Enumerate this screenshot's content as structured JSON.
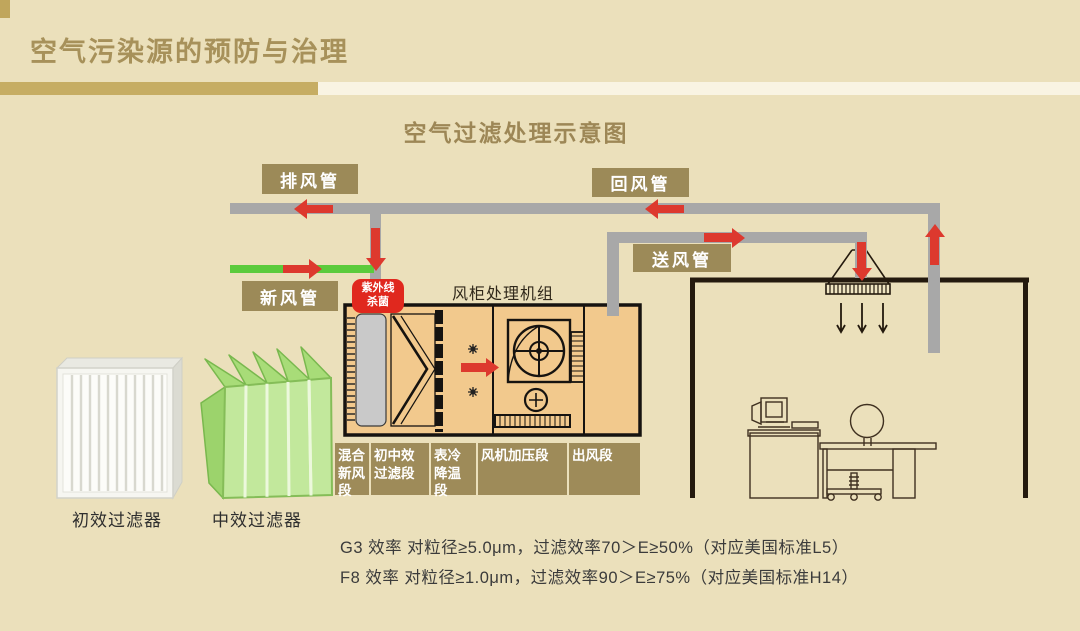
{
  "slide": {
    "title": "空气污染源的预防与治理",
    "subtitle": "空气过滤处理示意图"
  },
  "ducts": {
    "exhaust_label": "排风管",
    "return_label": "回风管",
    "fresh_label": "新风管",
    "supply_label": "送风管"
  },
  "uv": {
    "line1": "紫外线",
    "line2": "杀菌"
  },
  "ahu": {
    "title": "风柜处理机组",
    "sections": [
      "混合新风段",
      "初中效过滤段",
      "表冷降温段",
      "风机加压段",
      "出风段"
    ]
  },
  "filters": {
    "primary_label": "初效过滤器",
    "medium_label": "中效过滤器"
  },
  "notes": {
    "g3": "G3 效率 对粒径≥5.0μm，过滤效率70＞E≥50%（对应美国标准L5）",
    "f8": "F8 效率 对粒径≥1.0μm，过滤效率90＞E≥75%（对应美国标准H14）"
  },
  "colors": {
    "background": "#ebe0bb",
    "label_gold": "#9c8a58",
    "title_gold": "#a7915a",
    "bar_gold": "#c6ad63",
    "flow_red": "#dd392e",
    "uv_red": "#e0281e",
    "fresh_green": "#5bcb3c",
    "duct_gray": "#a8a8a8",
    "ahu_fill": "#f2c98d"
  }
}
